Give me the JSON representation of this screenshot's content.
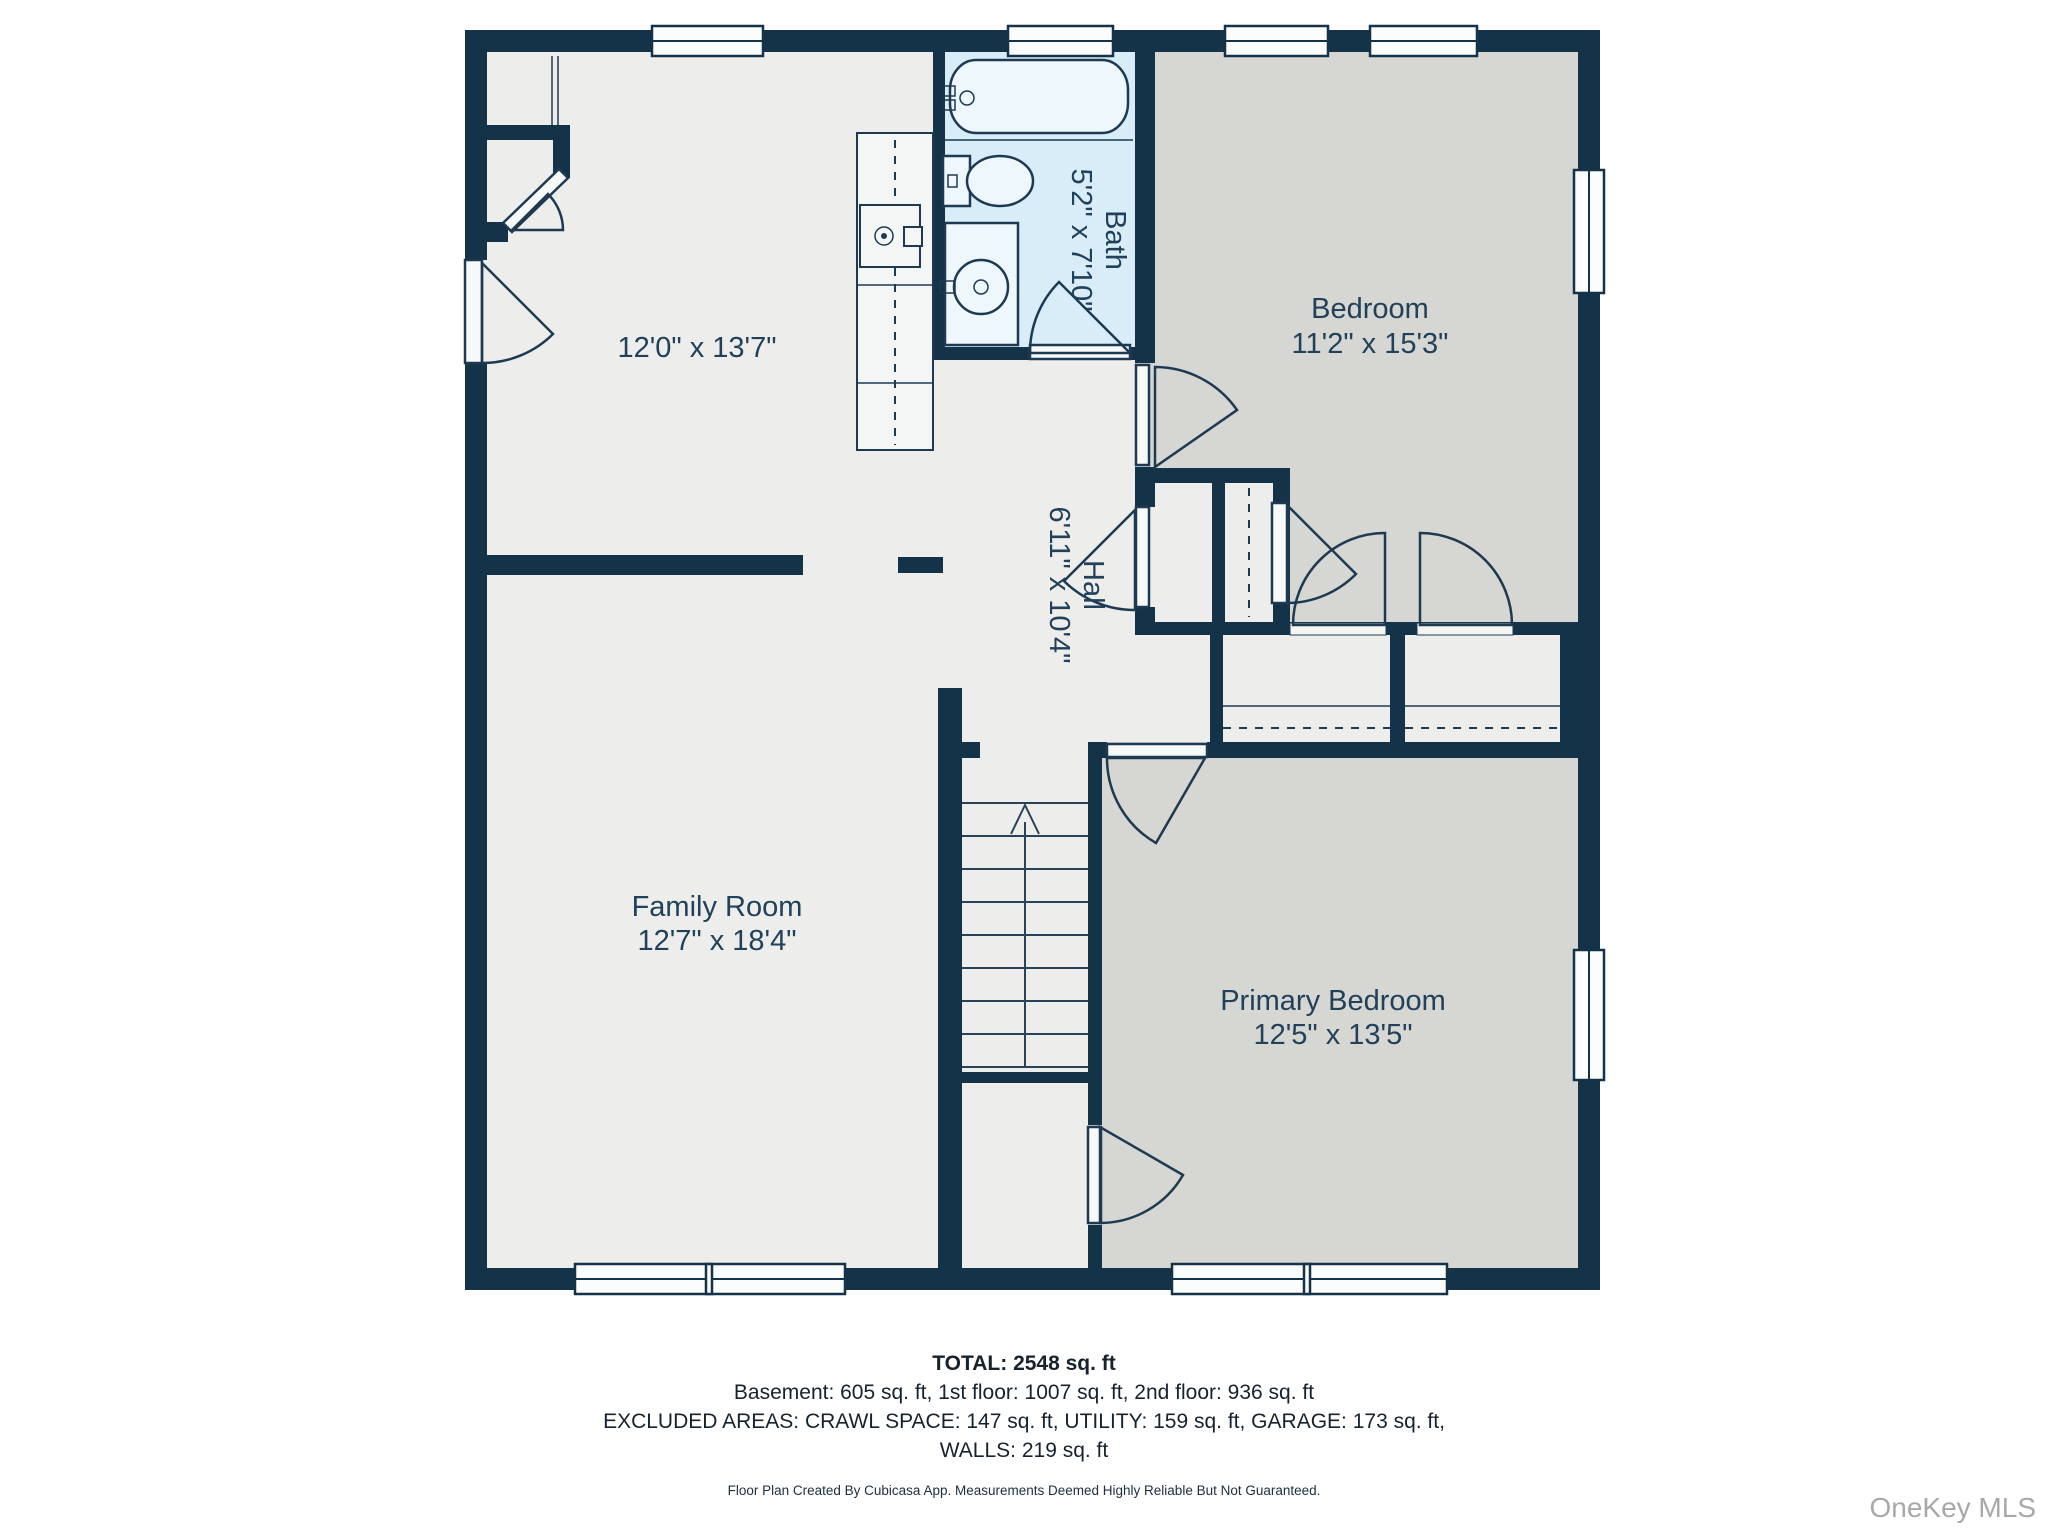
{
  "floor_plan": {
    "rooms": {
      "top_room": {
        "dims": "12'0\" x 13'7\""
      },
      "bath": {
        "name": "Bath",
        "dims": "5'2\" x 7'10\""
      },
      "bedroom": {
        "name": "Bedroom",
        "dims": "11'2\" x 15'3\""
      },
      "hall": {
        "name": "Hall",
        "dims": "6'11\" x 10'4\""
      },
      "family_room": {
        "name": "Family Room",
        "dims": "12'7\" x 18'4\""
      },
      "primary_bedroom": {
        "name": "Primary Bedroom",
        "dims": "12'5\" x 13'5\""
      }
    }
  },
  "summary": {
    "total": "TOTAL: 2548 sq. ft",
    "floors": "Basement: 605 sq. ft, 1st floor: 1007 sq. ft, 2nd floor: 936 sq. ft",
    "excluded": "EXCLUDED AREAS: CRAWL SPACE: 147 sq. ft, UTILITY: 159 sq. ft, GARAGE: 173 sq. ft,",
    "excluded2": "WALLS: 219 sq. ft"
  },
  "disclaimer": "Floor Plan Created By Cubicasa App. Measurements Deemed Highly Reliable But Not Guaranteed.",
  "watermark": "OneKey MLS",
  "colors": {
    "wall": "#143349",
    "floor_light": "#edeeeb",
    "floor_gray": "#d6d7d2",
    "floor_bath": "#d9edf8",
    "label_text": "#21405a",
    "watermark_text": "#a8a8a8"
  }
}
